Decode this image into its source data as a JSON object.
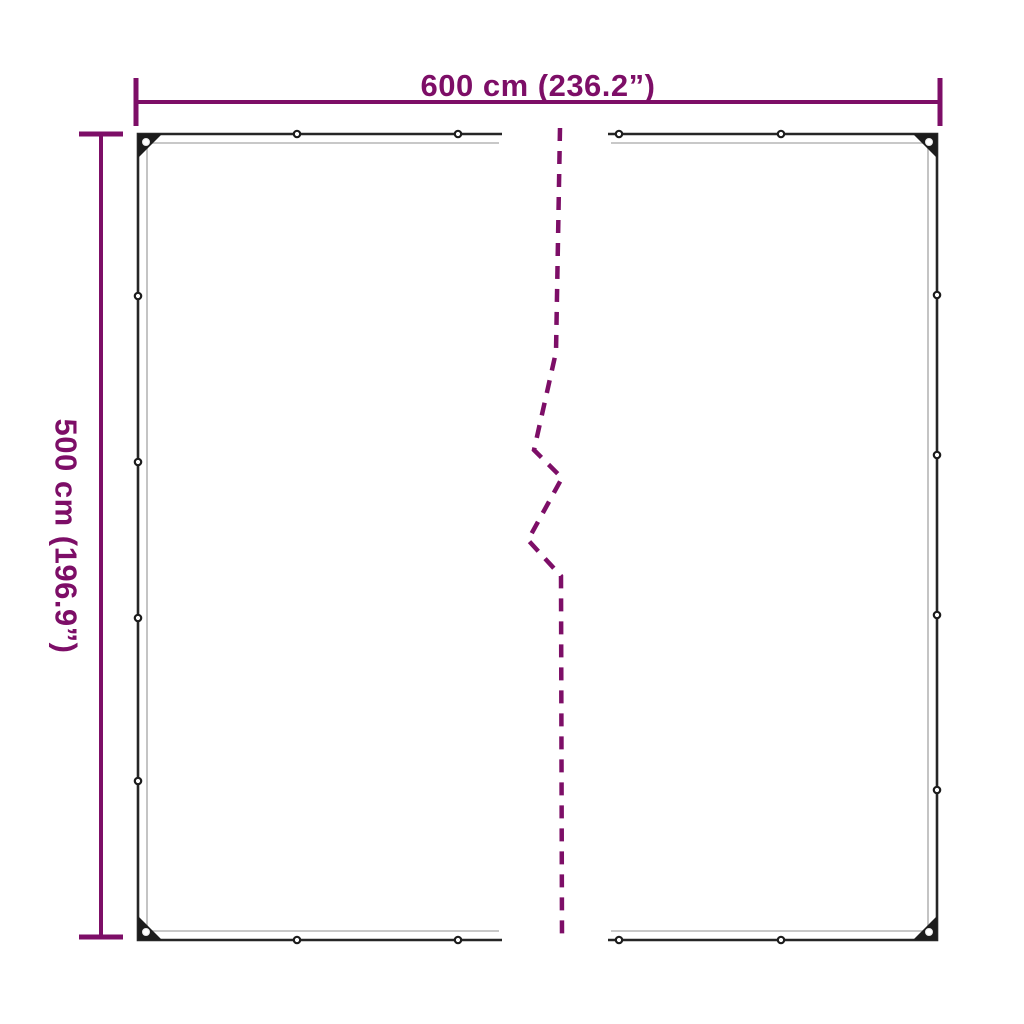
{
  "diagram": {
    "width_label": "600 cm (236.2”)",
    "height_label": "500 cm (196.9”)",
    "colors": {
      "dimension": "#7d0e67",
      "outline": "#262626",
      "hem": "#b5b5b5",
      "grommet": "#1c1c1c",
      "background": "#ffffff"
    }
  }
}
